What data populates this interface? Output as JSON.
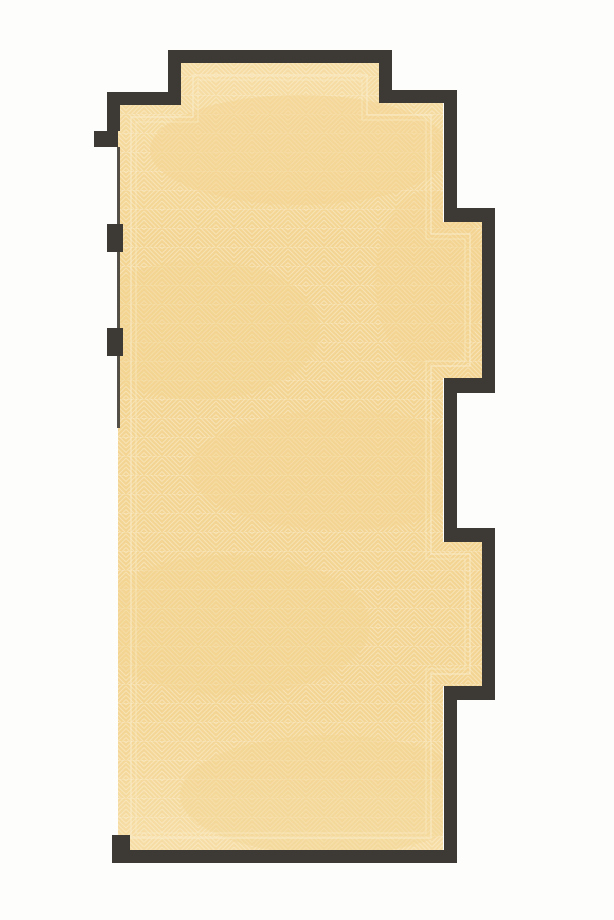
{
  "document": {
    "type": "architectural-floor-plan",
    "subject": "stepped room with herringbone parquet flooring, solid dark walls, window wall with piers on left"
  },
  "canvas": {
    "width": 614,
    "height": 920
  },
  "colors": {
    "paper": "#fdfdfb",
    "floor": "#f3d492",
    "floor_light": "#f6dda5",
    "pattern_line": "#fcf1d6",
    "border_line": "#faeecd",
    "wall": "#3d3a36",
    "window_line": "#45423d"
  },
  "floor_polygon": [
    [
      181,
      63
    ],
    [
      379,
      63
    ],
    [
      379,
      103
    ],
    [
      443,
      103
    ],
    [
      443,
      222
    ],
    [
      482,
      222
    ],
    [
      482,
      378
    ],
    [
      443,
      378
    ],
    [
      443,
      542
    ],
    [
      482,
      542
    ],
    [
      482,
      686
    ],
    [
      443,
      686
    ],
    [
      443,
      850
    ],
    [
      118,
      850
    ],
    [
      118,
      105
    ],
    [
      181,
      105
    ]
  ],
  "border_lines": [
    {
      "name": "parquet-border-outer",
      "opacity": 0.75,
      "width": 1.2,
      "points": [
        [
          193,
          75
        ],
        [
          367,
          75
        ],
        [
          367,
          115
        ],
        [
          431,
          115
        ],
        [
          431,
          234
        ],
        [
          470,
          234
        ],
        [
          470,
          366
        ],
        [
          431,
          366
        ],
        [
          431,
          554
        ],
        [
          470,
          554
        ],
        [
          470,
          674
        ],
        [
          431,
          674
        ],
        [
          431,
          838
        ],
        [
          131,
          838
        ],
        [
          131,
          117
        ],
        [
          193,
          117
        ]
      ]
    },
    {
      "name": "parquet-border-inner",
      "opacity": 0.55,
      "width": 1,
      "points": [
        [
          198,
          80
        ],
        [
          362,
          80
        ],
        [
          362,
          120
        ],
        [
          426,
          120
        ],
        [
          426,
          239
        ],
        [
          465,
          239
        ],
        [
          465,
          361
        ],
        [
          426,
          361
        ],
        [
          426,
          559
        ],
        [
          465,
          559
        ],
        [
          465,
          669
        ],
        [
          426,
          669
        ],
        [
          426,
          833
        ],
        [
          136,
          833
        ],
        [
          136,
          122
        ],
        [
          198,
          122
        ]
      ]
    }
  ],
  "walls": [
    {
      "name": "top-box-top",
      "x": 168,
      "y": 50,
      "w": 224,
      "h": 13
    },
    {
      "name": "top-box-left",
      "x": 168,
      "y": 50,
      "w": 13,
      "h": 55
    },
    {
      "name": "top-box-right",
      "x": 379,
      "y": 50,
      "w": 13,
      "h": 53
    },
    {
      "name": "shoulder-left",
      "x": 107,
      "y": 92,
      "w": 74,
      "h": 13
    },
    {
      "name": "shoulder-right",
      "x": 379,
      "y": 90,
      "w": 78,
      "h": 13
    },
    {
      "name": "left-upper",
      "x": 107,
      "y": 92,
      "w": 13,
      "h": 39
    },
    {
      "name": "left-notch",
      "x": 94,
      "y": 131,
      "w": 24,
      "h": 16
    },
    {
      "name": "right-upper",
      "x": 444,
      "y": 90,
      "w": 13,
      "h": 132
    },
    {
      "name": "bay1-top",
      "x": 444,
      "y": 208,
      "w": 51,
      "h": 14
    },
    {
      "name": "bay1-right",
      "x": 482,
      "y": 208,
      "w": 13,
      "h": 185
    },
    {
      "name": "bay1-bottom",
      "x": 444,
      "y": 378,
      "w": 51,
      "h": 15
    },
    {
      "name": "right-mid",
      "x": 444,
      "y": 378,
      "w": 13,
      "h": 164
    },
    {
      "name": "bay2-top",
      "x": 444,
      "y": 528,
      "w": 51,
      "h": 14
    },
    {
      "name": "bay2-right",
      "x": 482,
      "y": 528,
      "w": 13,
      "h": 172
    },
    {
      "name": "bay2-bottom",
      "x": 444,
      "y": 686,
      "w": 51,
      "h": 14
    },
    {
      "name": "right-lower",
      "x": 444,
      "y": 686,
      "w": 13,
      "h": 177
    },
    {
      "name": "bottom",
      "x": 112,
      "y": 850,
      "w": 345,
      "h": 13
    },
    {
      "name": "bottom-left-end",
      "x": 112,
      "y": 835,
      "w": 18,
      "h": 17
    }
  ],
  "window_wall": {
    "x": 117,
    "y": 147,
    "w": 3,
    "h": 281
  },
  "piers": [
    {
      "name": "left-pier-1",
      "x": 107,
      "y": 224,
      "w": 16,
      "h": 28
    },
    {
      "name": "left-pier-2",
      "x": 107,
      "y": 328,
      "w": 16,
      "h": 28
    }
  ],
  "pattern": {
    "tile_w": 36,
    "tile_h": 38,
    "cell_w": 18,
    "cell_h": 19,
    "spacing": 4.5,
    "line_width": 1.1,
    "diag_opacity": 0.5,
    "course_line_opacity": 0.28
  },
  "texture": {
    "fade_spots": [
      {
        "cx": 300,
        "cy": 150,
        "rx": 150,
        "ry": 55,
        "o": 0.5
      },
      {
        "cx": 200,
        "cy": 330,
        "rx": 120,
        "ry": 70,
        "o": 0.4
      },
      {
        "cx": 430,
        "cy": 280,
        "rx": 55,
        "ry": 90,
        "o": 0.35
      },
      {
        "cx": 340,
        "cy": 470,
        "rx": 150,
        "ry": 60,
        "o": 0.45
      },
      {
        "cx": 230,
        "cy": 625,
        "rx": 140,
        "ry": 70,
        "o": 0.4
      },
      {
        "cx": 330,
        "cy": 795,
        "rx": 150,
        "ry": 60,
        "o": 0.4
      }
    ]
  }
}
